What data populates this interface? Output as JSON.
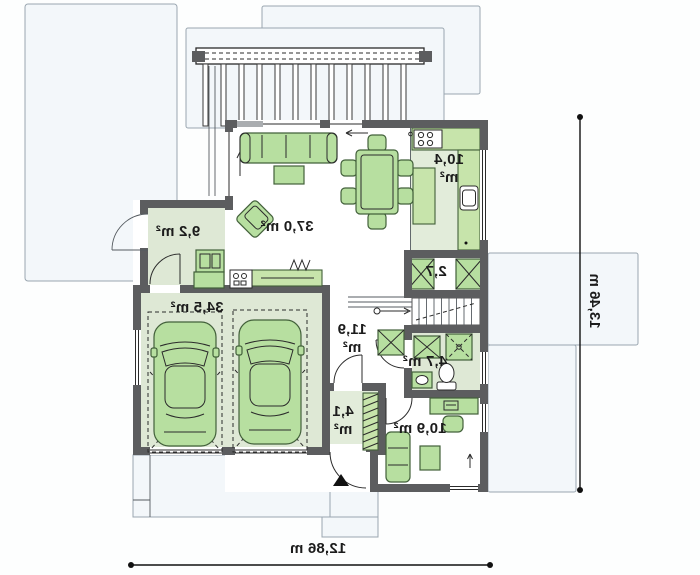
{
  "meta": {
    "type": "house-floor-plan",
    "mirrored": true,
    "floor": "ground floor"
  },
  "rooms": [
    {
      "name": "living-room",
      "label": "37,0 m²"
    },
    {
      "name": "kitchen",
      "area": "10,4",
      "unit": "m²"
    },
    {
      "name": "pantry",
      "label": "2,7"
    },
    {
      "name": "utility-room",
      "label": "9,2 m²"
    },
    {
      "name": "garage",
      "label": "34,5 m²"
    },
    {
      "name": "hall",
      "area": "11,9",
      "unit": "m²"
    },
    {
      "name": "bathroom",
      "label": "4,7 m²"
    },
    {
      "name": "vestibule",
      "area": "4,1",
      "unit": "m²"
    },
    {
      "name": "office",
      "label": "10,9 m²"
    }
  ],
  "dimensions": {
    "width": "12,86 m",
    "height": "13,46 m"
  },
  "colors": {
    "wall": "#5c5d5f",
    "floor_green": "#dee8d5",
    "furniture_green": "#b7dfa0",
    "counter_green": "#c7e4ab",
    "site_fill": "#f3f7fa",
    "ink": "#1c1c1c"
  }
}
